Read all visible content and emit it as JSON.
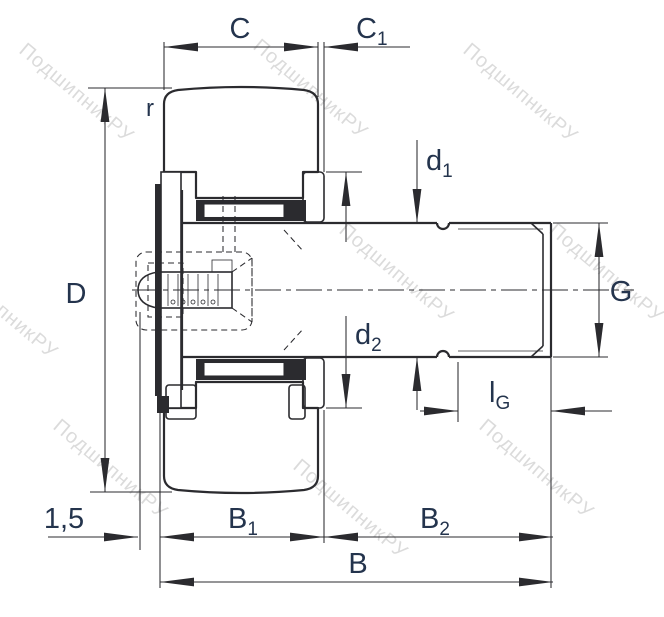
{
  "title": "Stud-type track roller (cam follower) sectional technical drawing",
  "colors": {
    "background": "#ffffff",
    "line": "#2b2b2f",
    "label": "#24344d",
    "watermark": "#b9b9b9"
  },
  "watermark": {
    "text": "ПодшипникРУ"
  },
  "dimensions": {
    "c": {
      "label": "C"
    },
    "c1": {
      "base": "C",
      "sub": "1"
    },
    "r": {
      "label": "r"
    },
    "d_outer": {
      "label": "D"
    },
    "d1": {
      "base": "d",
      "sub": "1"
    },
    "d2": {
      "base": "d",
      "sub": "2"
    },
    "g": {
      "label": "G"
    },
    "lg": {
      "base": "l",
      "sub": "G"
    },
    "offset": {
      "label": "1,5"
    },
    "b1": {
      "base": "B",
      "sub": "1"
    },
    "b2": {
      "base": "B",
      "sub": "2"
    },
    "b": {
      "label": "B"
    }
  }
}
